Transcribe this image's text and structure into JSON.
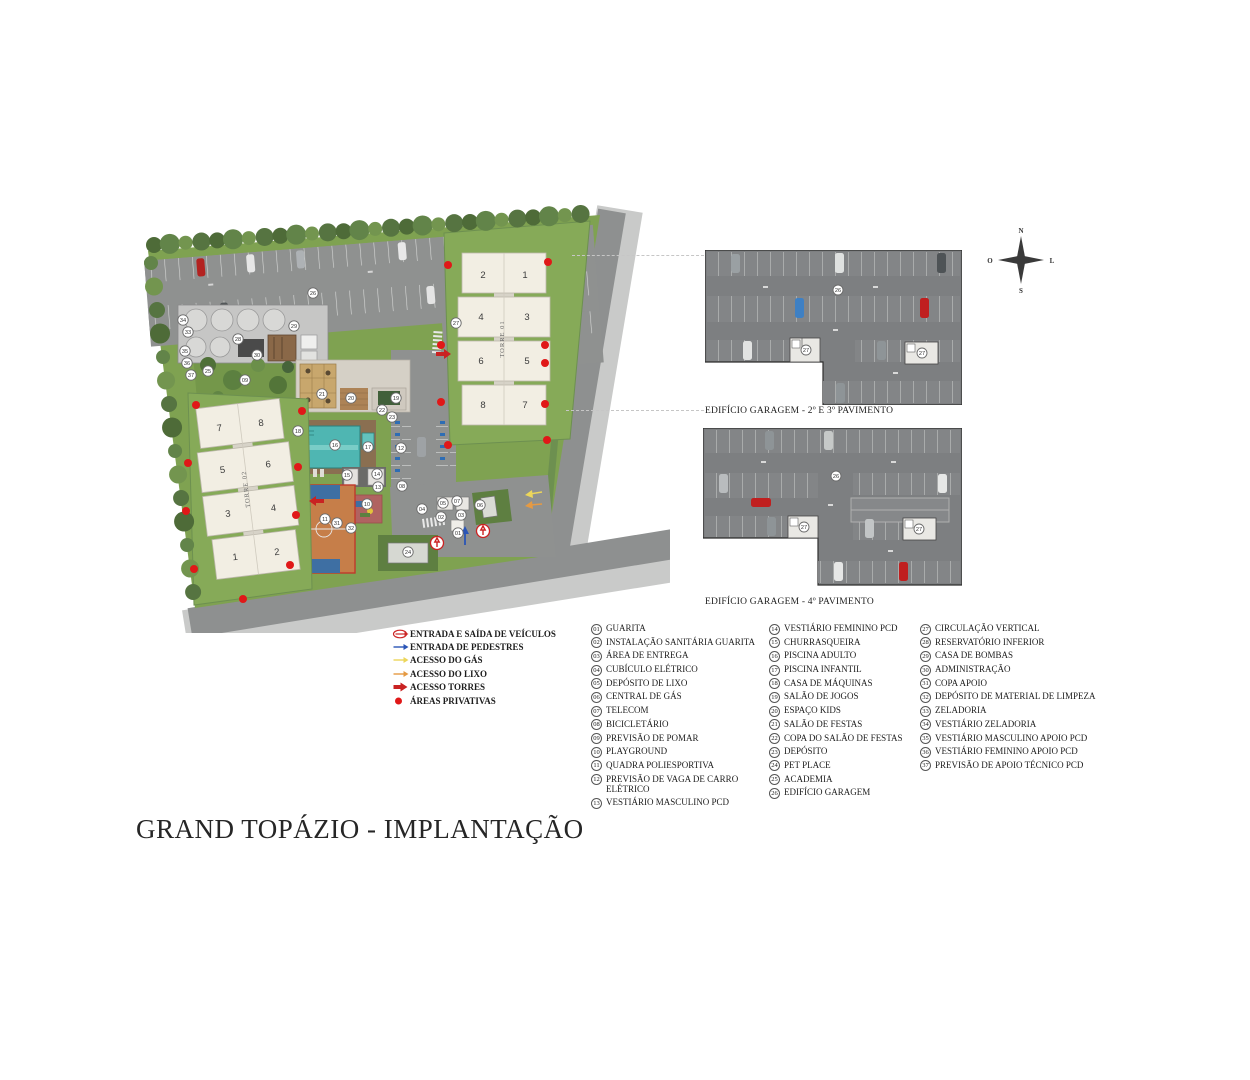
{
  "title": "GRAND TOPÁZIO - IMPLANTAÇÃO",
  "compass": {
    "n": "N",
    "s": "S",
    "l": "L",
    "o": "O"
  },
  "site_plan": {
    "tower1": {
      "label": "TORRE 01",
      "units": [
        "2",
        "1",
        "4",
        "3",
        "6",
        "5",
        "8",
        "7"
      ]
    },
    "tower2": {
      "label": "TORRE 02",
      "units": [
        "7",
        "8",
        "5",
        "6",
        "3",
        "4",
        "1",
        "2"
      ]
    },
    "markers": [
      {
        "n": "01",
        "x": 320,
        "y": 328
      },
      {
        "n": "02",
        "x": 303,
        "y": 312
      },
      {
        "n": "03",
        "x": 323,
        "y": 310
      },
      {
        "n": "04",
        "x": 284,
        "y": 304
      },
      {
        "n": "05",
        "x": 305,
        "y": 298
      },
      {
        "n": "06",
        "x": 342,
        "y": 300
      },
      {
        "n": "07",
        "x": 319,
        "y": 296
      },
      {
        "n": "08",
        "x": 264,
        "y": 281
      },
      {
        "n": "09",
        "x": 107,
        "y": 175
      },
      {
        "n": "10",
        "x": 229,
        "y": 299
      },
      {
        "n": "11",
        "x": 187,
        "y": 314
      },
      {
        "n": "12",
        "x": 263,
        "y": 243
      },
      {
        "n": "13",
        "x": 240,
        "y": 282
      },
      {
        "n": "14",
        "x": 239,
        "y": 269
      },
      {
        "n": "15",
        "x": 209,
        "y": 270
      },
      {
        "n": "16",
        "x": 197,
        "y": 240
      },
      {
        "n": "17",
        "x": 230,
        "y": 242
      },
      {
        "n": "18",
        "x": 160,
        "y": 226
      },
      {
        "n": "19",
        "x": 258,
        "y": 193
      },
      {
        "n": "20",
        "x": 213,
        "y": 193
      },
      {
        "n": "21",
        "x": 184,
        "y": 189
      },
      {
        "n": "22",
        "x": 244,
        "y": 205
      },
      {
        "n": "23",
        "x": 254,
        "y": 212
      },
      {
        "n": "24",
        "x": 270,
        "y": 347
      },
      {
        "n": "25",
        "x": 70,
        "y": 166
      },
      {
        "n": "26",
        "x": 175,
        "y": 88
      },
      {
        "n": "27",
        "x": 318,
        "y": 118
      },
      {
        "n": "28",
        "x": 100,
        "y": 134
      },
      {
        "n": "29",
        "x": 156,
        "y": 121
      },
      {
        "n": "30",
        "x": 119,
        "y": 150
      },
      {
        "n": "31",
        "x": 199,
        "y": 318
      },
      {
        "n": "32",
        "x": 213,
        "y": 323
      },
      {
        "n": "33",
        "x": 50,
        "y": 127
      },
      {
        "n": "34",
        "x": 45,
        "y": 115
      },
      {
        "n": "35",
        "x": 47,
        "y": 146
      },
      {
        "n": "36",
        "x": 49,
        "y": 158
      },
      {
        "n": "37",
        "x": 53,
        "y": 170
      }
    ]
  },
  "garage_plans": [
    {
      "label": "EDIFÍCIO GARAGEM - 2º E 3º PAVIMENTO",
      "markers": [
        {
          "n": "26",
          "x": 133,
          "y": 40
        },
        {
          "n": "27",
          "x": 101,
          "y": 100
        },
        {
          "n": "27",
          "x": 217,
          "y": 103
        }
      ]
    },
    {
      "label": "EDIFÍCIO GARAGEM - 4º PAVIMENTO",
      "markers": [
        {
          "n": "26",
          "x": 133,
          "y": 48
        },
        {
          "n": "27",
          "x": 101,
          "y": 99
        },
        {
          "n": "27",
          "x": 216,
          "y": 101
        }
      ]
    }
  ],
  "access_legend": [
    {
      "icon": "double-arrow",
      "color": "#cc2626",
      "label": "ENTRADA E SAÍDA DE VEÍCULOS"
    },
    {
      "icon": "arrow",
      "color": "#2a55b7",
      "label": "ENTRADA DE PEDESTRES"
    },
    {
      "icon": "arrow",
      "color": "#ecd65a",
      "label": "ACESSO DO GÁS"
    },
    {
      "icon": "arrow",
      "color": "#e59a43",
      "label": "ACESSO DO LIXO"
    },
    {
      "icon": "bold-arrow",
      "color": "#c92222",
      "label": "ACESSO TORRES"
    },
    {
      "icon": "dot",
      "color": "#e01818",
      "label": "ÁREAS PRIVATIVAS"
    }
  ],
  "legend": {
    "columns": [
      [
        {
          "num": "01",
          "label": "GUARITA"
        },
        {
          "num": "02",
          "label": "INSTALAÇÃO SANITÁRIA GUARITA"
        },
        {
          "num": "03",
          "label": "ÁREA DE ENTREGA"
        },
        {
          "num": "04",
          "label": "CUBÍCULO ELÉTRICO"
        },
        {
          "num": "05",
          "label": "DEPÓSITO DE LIXO"
        },
        {
          "num": "06",
          "label": "CENTRAL DE GÁS"
        },
        {
          "num": "07",
          "label": "TELECOM"
        },
        {
          "num": "08",
          "label": "BICICLETÁRIO"
        },
        {
          "num": "09",
          "label": "PREVISÃO DE POMAR"
        },
        {
          "num": "10",
          "label": "PLAYGROUND"
        },
        {
          "num": "11",
          "label": "QUADRA POLIESPORTIVA"
        },
        {
          "num": "12",
          "label": "PREVISÃO DE VAGA DE CARRO ELÉTRICO"
        },
        {
          "num": "13",
          "label": "VESTIÁRIO MASCULINO PCD"
        }
      ],
      [
        {
          "num": "14",
          "label": "VESTIÁRIO FEMININO PCD"
        },
        {
          "num": "15",
          "label": "CHURRASQUEIRA"
        },
        {
          "num": "16",
          "label": "PISCINA ADULTO"
        },
        {
          "num": "17",
          "label": "PISCINA INFANTIL"
        },
        {
          "num": "18",
          "label": "CASA DE MÁQUINAS"
        },
        {
          "num": "19",
          "label": "SALÃO DE JOGOS"
        },
        {
          "num": "20",
          "label": "ESPAÇO KIDS"
        },
        {
          "num": "21",
          "label": "SALÃO DE FESTAS"
        },
        {
          "num": "22",
          "label": "COPA DO SALÃO DE FESTAS"
        },
        {
          "num": "23",
          "label": "DEPÓSITO"
        },
        {
          "num": "24",
          "label": "PET PLACE"
        },
        {
          "num": "25",
          "label": "ACADEMIA"
        },
        {
          "num": "26",
          "label": "EDIFÍCIO GARAGEM"
        }
      ],
      [
        {
          "num": "27",
          "label": "CIRCULAÇÃO VERTICAL"
        },
        {
          "num": "28",
          "label": "RESERVATÓRIO INFERIOR"
        },
        {
          "num": "29",
          "label": "CASA DE BOMBAS"
        },
        {
          "num": "30",
          "label": "ADMINISTRAÇÃO"
        },
        {
          "num": "31",
          "label": "COPA APOIO"
        },
        {
          "num": "32",
          "label": "DEPÓSITO DE MATERIAL DE LIMPEZA"
        },
        {
          "num": "33",
          "label": "ZELADORIA"
        },
        {
          "num": "34",
          "label": "VESTIÁRIO ZELADORIA"
        },
        {
          "num": "35",
          "label": "VESTIÁRIO MASCULINO APOIO PCD"
        },
        {
          "num": "36",
          "label": "VESTIÁRIO FEMININO APOIO PCD"
        },
        {
          "num": "37",
          "label": "PREVISÃO DE APOIO TÉCNICO PCD"
        }
      ]
    ]
  }
}
